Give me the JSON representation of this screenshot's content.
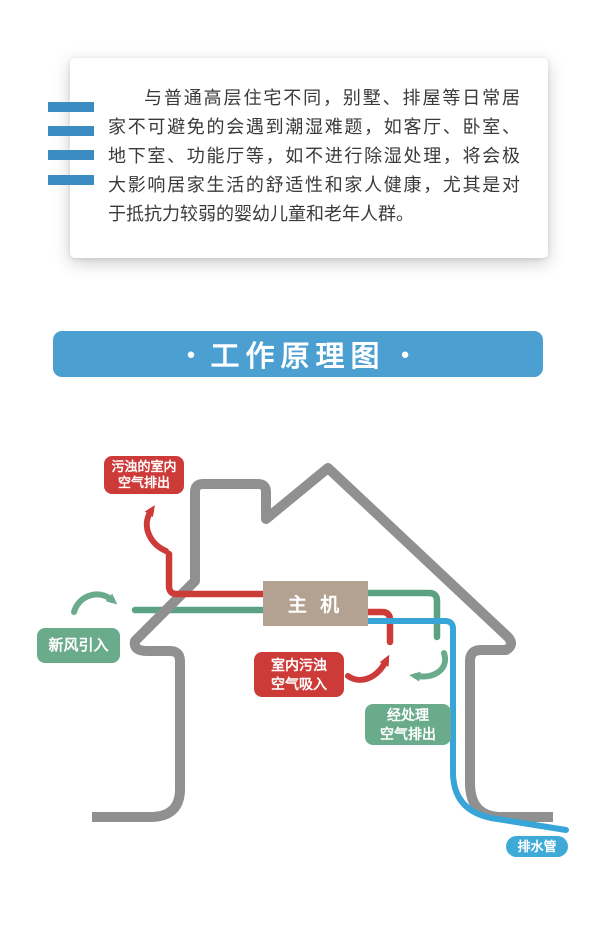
{
  "intro_card": {
    "lines": [
      "与普通高层住宅不同，别墅、排屋等日常居",
      "家不可避免的会遇到潮湿难题，如客厅、卧室、",
      "地下室、功能厅等，如不进行除湿处理，将会极",
      "大影响居家生活的舒适性和家人健康，尤其是对",
      "于抵抗力较弱的婴幼儿童和老年人群。"
    ]
  },
  "section_banner": {
    "bullet": "●",
    "title": "工作原理图"
  },
  "diagram": {
    "main_unit_label": "主 机",
    "labels": {
      "dirty_air_out": {
        "line1": "污浊的室内",
        "line2": "空气排出"
      },
      "fresh_air_in": {
        "text": "新风引入"
      },
      "indoor_dirty_in": {
        "line1": "室内污浊",
        "line2": "空气吸入"
      },
      "treated_air_out": {
        "line1": "经处理",
        "line2": "空气排出"
      },
      "drain_pipe": {
        "text": "排水管"
      }
    }
  },
  "palette": {
    "accent_blue": "#3b8cc1",
    "banner_blue": "#4c9fd1",
    "house_gray": "#909090",
    "pipe_red": "#cd3b38",
    "pipe_green": "#5ba183",
    "pipe_blue": "#38a5d8",
    "label_green": "#6aab8c",
    "drain_label_blue": "#3fa9d8",
    "unit_box_tan": "#b3a291",
    "text_dark": "#3a3a3a"
  }
}
